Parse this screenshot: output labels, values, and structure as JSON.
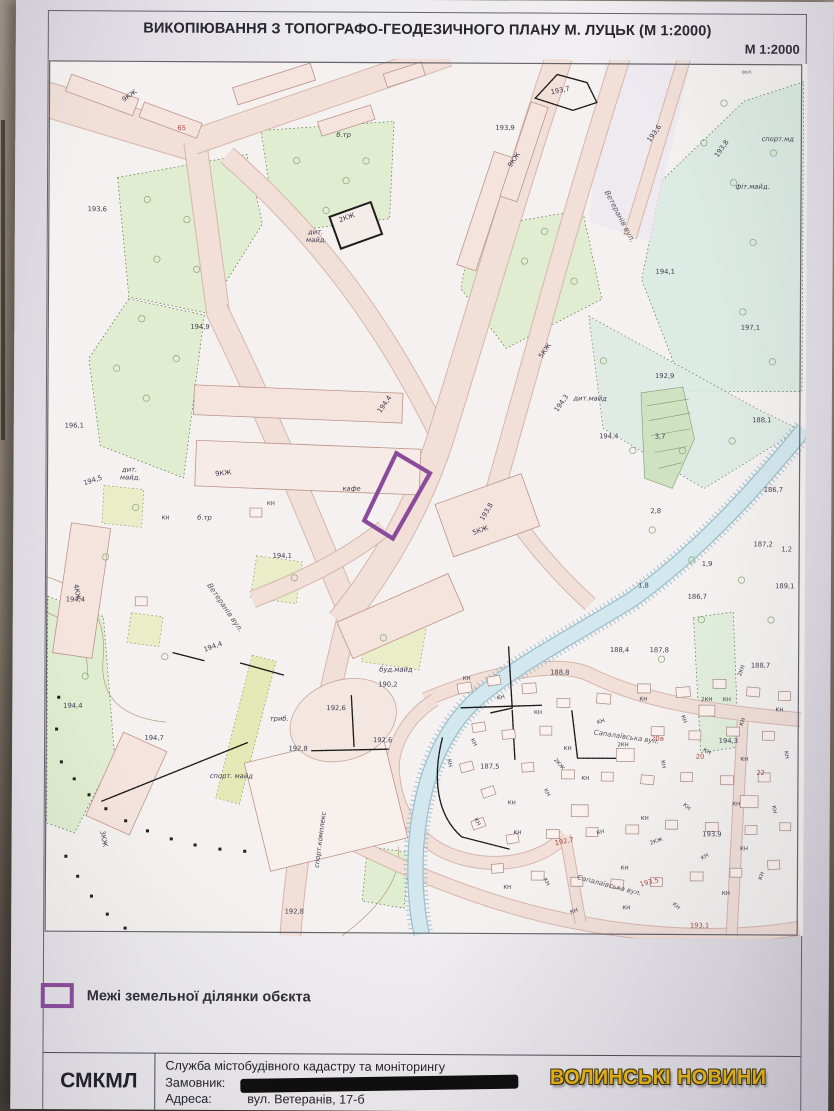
{
  "photo": {
    "watermark": "ВОЛИНСЬКІ НОВИНИ",
    "watermark_color": "#eab511"
  },
  "sheet": {
    "title": "ВИКОПІЮВАННЯ З ТОПОГРАФО-ГЕОДЕЗИЧНОГО ПЛАНУ М. ЛУЦЬК (М 1:2000)",
    "scale_label": "М 1:2000",
    "legend": {
      "swatch_color": "#8b4b9b",
      "label": "Межі земельної ділянки обєкта"
    },
    "footer": {
      "org_abbr": "СМКМЛ",
      "org_name": "Служба містобудівного кадастру та моніторингу",
      "customer_label": "Замовник:",
      "customer_value_redacted": true,
      "address_label": "Адреса:",
      "address_value": "вул. Ветеранів, 17-б"
    }
  },
  "map": {
    "parcel_color": "#8b4b9b",
    "label_colors": {
      "d": "#3c3c4e",
      "r": "#a8473d",
      "g": "#5b5762",
      "b": "#8a6f4e"
    },
    "labels": [
      {
        "t": "вол.",
        "x": 698,
        "y": 10,
        "s": 5,
        "c": "g"
      },
      {
        "t": "193,6",
        "x": 40,
        "y": 152
      },
      {
        "t": "194,9",
        "x": 144,
        "y": 270
      },
      {
        "t": "196,1",
        "x": 18,
        "y": 370
      },
      {
        "t": "194,5",
        "x": 38,
        "y": 428,
        "r": -18
      },
      {
        "t": "194,4",
        "x": 20,
        "y": 545
      },
      {
        "t": "194,1",
        "x": 228,
        "y": 500
      },
      {
        "t": "194,7",
        "x": 100,
        "y": 684
      },
      {
        "t": "194,4",
        "x": 18,
        "y": 652
      },
      {
        "t": "190,2",
        "x": 335,
        "y": 629
      },
      {
        "t": "192,8",
        "x": 245,
        "y": 694
      },
      {
        "t": "192,6",
        "x": 283,
        "y": 653
      },
      {
        "t": "192,6",
        "x": 330,
        "y": 685
      },
      {
        "t": "192,8",
        "x": 242,
        "y": 858
      },
      {
        "t": "194,4",
        "x": 160,
        "y": 595,
        "r": -20
      },
      {
        "t": "193,9",
        "x": 450,
        "y": 68
      },
      {
        "t": "193,7",
        "x": 506,
        "y": 32,
        "r": -12
      },
      {
        "t": "193,6",
        "x": 606,
        "y": 80,
        "r": -55
      },
      {
        "t": "193,8",
        "x": 674,
        "y": 95,
        "r": -55
      },
      {
        "t": "193,8",
        "x": 440,
        "y": 462,
        "r": -60
      },
      {
        "t": "194,1",
        "x": 612,
        "y": 212
      },
      {
        "t": "197,1",
        "x": 698,
        "y": 268
      },
      {
        "t": "192,9",
        "x": 612,
        "y": 317
      },
      {
        "t": "194,4",
        "x": 556,
        "y": 378
      },
      {
        "t": "3,7",
        "x": 612,
        "y": 378
      },
      {
        "t": "188,1",
        "x": 710,
        "y": 361
      },
      {
        "t": "186,7",
        "x": 722,
        "y": 431
      },
      {
        "t": "2,8",
        "x": 608,
        "y": 453
      },
      {
        "t": "187,2",
        "x": 712,
        "y": 486
      },
      {
        "t": "1,2",
        "x": 740,
        "y": 491
      },
      {
        "t": "189,1",
        "x": 734,
        "y": 528
      },
      {
        "t": "1,9",
        "x": 660,
        "y": 506
      },
      {
        "t": "1,8",
        "x": 596,
        "y": 528
      },
      {
        "t": "186,7",
        "x": 646,
        "y": 539
      },
      {
        "t": "188,4",
        "x": 568,
        "y": 593
      },
      {
        "t": "187,8",
        "x": 608,
        "y": 593
      },
      {
        "t": "188,8",
        "x": 508,
        "y": 616
      },
      {
        "t": "188,7",
        "x": 710,
        "y": 608
      },
      {
        "t": "194,3",
        "x": 678,
        "y": 684
      },
      {
        "t": "187,5",
        "x": 438,
        "y": 711
      },
      {
        "t": "193,9",
        "x": 662,
        "y": 778
      },
      {
        "t": "194,3",
        "x": 514,
        "y": 352,
        "r": -55
      },
      {
        "t": "194,4",
        "x": 336,
        "y": 354,
        "r": -55
      },
      {
        "t": "65",
        "x": 130,
        "y": 70,
        "c": "r"
      },
      {
        "t": "192,7",
        "x": 514,
        "y": 788,
        "c": "r",
        "r": -12
      },
      {
        "t": "193,5",
        "x": 600,
        "y": 829,
        "c": "r",
        "r": -14
      },
      {
        "t": "193,1",
        "x": 650,
        "y": 870,
        "c": "r"
      },
      {
        "t": "20а",
        "x": 610,
        "y": 682,
        "c": "r"
      },
      {
        "t": "20",
        "x": 655,
        "y": 700,
        "c": "r"
      },
      {
        "t": "22",
        "x": 716,
        "y": 716,
        "c": "r"
      },
      {
        "t": "дит.",
        "x": 262,
        "y": 174,
        "i": 1
      },
      {
        "t": "майд.",
        "x": 260,
        "y": 182,
        "i": 1
      },
      {
        "t": "дит.",
        "x": 76,
        "y": 414,
        "i": 1
      },
      {
        "t": "майд.",
        "x": 74,
        "y": 422,
        "i": 1
      },
      {
        "t": "дит.майд",
        "x": 530,
        "y": 340,
        "i": 1
      },
      {
        "t": "б.тр",
        "x": 290,
        "y": 76,
        "i": 1
      },
      {
        "t": "б.тр",
        "x": 152,
        "y": 462,
        "i": 1
      },
      {
        "t": "спорт.мд",
        "x": 718,
        "y": 78,
        "i": 1
      },
      {
        "t": "фіт.майд.",
        "x": 692,
        "y": 126,
        "i": 1
      },
      {
        "t": "триб.",
        "x": 226,
        "y": 664,
        "i": 1
      },
      {
        "t": "буд.майд",
        "x": 336,
        "y": 614,
        "i": 1
      },
      {
        "t": "спорт. майд",
        "x": 166,
        "y": 722,
        "i": 1
      },
      {
        "t": "спорт.комплекс",
        "x": 276,
        "y": 812,
        "i": 1,
        "r": -83
      },
      {
        "t": "кафе",
        "x": 298,
        "y": 432,
        "i": 1
      },
      {
        "t": "9КЖ",
        "x": 76,
        "y": 42,
        "r": -35
      },
      {
        "t": "9КЖ",
        "x": 170,
        "y": 418,
        "r": -6
      },
      {
        "t": "9КЖ",
        "x": 466,
        "y": 106,
        "r": -55
      },
      {
        "t": "5КЖ",
        "x": 498,
        "y": 298,
        "r": -55
      },
      {
        "t": "5КЖ",
        "x": 430,
        "y": 476,
        "r": -20
      },
      {
        "t": "4КЖ",
        "x": 28,
        "y": 528,
        "r": 80
      },
      {
        "t": "3КЖ",
        "x": 56,
        "y": 776,
        "r": 80
      },
      {
        "t": "2КЖ",
        "x": 294,
        "y": 162,
        "r": -20
      },
      {
        "t": "КН",
        "x": 222,
        "y": 447,
        "s": 5.5
      },
      {
        "t": "КН",
        "x": 116,
        "y": 462,
        "s": 5.5
      },
      {
        "t": "Ветеранів вул.",
        "x": 560,
        "y": 130,
        "r": 62,
        "c": "g",
        "s": 7.5,
        "i": 1
      },
      {
        "t": "Ветеранів вул.",
        "x": 162,
        "y": 528,
        "r": 55,
        "c": "g",
        "s": 7.5,
        "i": 1
      },
      {
        "t": "Сапалаївська вул.",
        "x": 552,
        "y": 676,
        "r": 8,
        "c": "g",
        "s": 7,
        "i": 1
      },
      {
        "t": "Сапалаївська вул.",
        "x": 536,
        "y": 822,
        "r": 14,
        "c": "g",
        "s": 7,
        "i": 1
      },
      {
        "t": "КН",
        "x": 455,
        "y": 642,
        "s": 5.5,
        "r": -15
      },
      {
        "t": "КН",
        "x": 492,
        "y": 656,
        "s": 5.5
      },
      {
        "t": "КН",
        "x": 428,
        "y": 682,
        "s": 5.5,
        "r": 60
      },
      {
        "t": "КН",
        "x": 522,
        "y": 692,
        "s": 5.5
      },
      {
        "t": "КН",
        "x": 556,
        "y": 666,
        "s": 5.5,
        "r": -20
      },
      {
        "t": "КН",
        "x": 598,
        "y": 642,
        "s": 5.5
      },
      {
        "t": "КН",
        "x": 640,
        "y": 657,
        "s": 5.5,
        "r": 70
      },
      {
        "t": "КН",
        "x": 682,
        "y": 642,
        "s": 5.5
      },
      {
        "t": "КН",
        "x": 702,
        "y": 667,
        "s": 5.5,
        "r": -70
      },
      {
        "t": "КН",
        "x": 735,
        "y": 652,
        "s": 5.5
      },
      {
        "t": "КН",
        "x": 744,
        "y": 692,
        "s": 5.5,
        "r": 80
      },
      {
        "t": "КН",
        "x": 700,
        "y": 702,
        "s": 5.5
      },
      {
        "t": "КН",
        "x": 662,
        "y": 692,
        "s": 5.5,
        "r": 30
      },
      {
        "t": "КН",
        "x": 620,
        "y": 702,
        "s": 5.5,
        "r": 80
      },
      {
        "t": "КН",
        "x": 540,
        "y": 722,
        "s": 5.5
      },
      {
        "t": "КН",
        "x": 502,
        "y": 732,
        "s": 5.5,
        "r": 60
      },
      {
        "t": "КН",
        "x": 466,
        "y": 747,
        "s": 5.5
      },
      {
        "t": "КН",
        "x": 432,
        "y": 762,
        "s": 5.5,
        "r": 60
      },
      {
        "t": "КН",
        "x": 472,
        "y": 777,
        "s": 5.5
      },
      {
        "t": "КН",
        "x": 556,
        "y": 777,
        "s": 5.5,
        "r": -15
      },
      {
        "t": "КН",
        "x": 600,
        "y": 762,
        "s": 5.5
      },
      {
        "t": "КН",
        "x": 642,
        "y": 747,
        "s": 5.5,
        "r": 40
      },
      {
        "t": "КН",
        "x": 692,
        "y": 747,
        "s": 5.5
      },
      {
        "t": "КН",
        "x": 732,
        "y": 747,
        "s": 5.5,
        "r": 80
      },
      {
        "t": "КН",
        "x": 700,
        "y": 792,
        "s": 5.5
      },
      {
        "t": "КН",
        "x": 662,
        "y": 802,
        "s": 5.5,
        "r": -30
      },
      {
        "t": "КН",
        "x": 580,
        "y": 812,
        "s": 5.5
      },
      {
        "t": "КН",
        "x": 502,
        "y": 822,
        "s": 5.5,
        "r": 60
      },
      {
        "t": "КН",
        "x": 462,
        "y": 832,
        "s": 5.5
      },
      {
        "t": "КН",
        "x": 530,
        "y": 857,
        "s": 5.5,
        "r": -20
      },
      {
        "t": "КН",
        "x": 582,
        "y": 852,
        "s": 5.5
      },
      {
        "t": "КН",
        "x": 632,
        "y": 847,
        "s": 5.5,
        "r": 40
      },
      {
        "t": "КН",
        "x": 682,
        "y": 837,
        "s": 5.5
      },
      {
        "t": "КН",
        "x": 722,
        "y": 822,
        "s": 5.5,
        "r": -70
      },
      {
        "t": "КН",
        "x": 420,
        "y": 622,
        "s": 5.5
      },
      {
        "t": "КН",
        "x": 405,
        "y": 702,
        "s": 5.5,
        "r": 80
      },
      {
        "t": "2КН",
        "x": 576,
        "y": 688,
        "s": 5.5
      },
      {
        "t": "2КН",
        "x": 700,
        "y": 617,
        "s": 5.5,
        "r": -70
      },
      {
        "t": "2КН",
        "x": 660,
        "y": 642,
        "s": 5.5
      },
      {
        "t": "2КЖ",
        "x": 512,
        "y": 702,
        "s": 5.5,
        "r": 50
      },
      {
        "t": "2КЖ",
        "x": 610,
        "y": 787,
        "s": 5.5,
        "r": -20
      }
    ],
    "houses": [
      [
        415,
        625,
        14,
        10,
        -10
      ],
      [
        445,
        618,
        13,
        9,
        -10
      ],
      [
        480,
        625,
        14,
        10,
        -5
      ],
      [
        515,
        640,
        13,
        9,
        0
      ],
      [
        555,
        635,
        14,
        10,
        5
      ],
      [
        596,
        625,
        13,
        9,
        0
      ],
      [
        635,
        628,
        14,
        10,
        -5
      ],
      [
        672,
        620,
        13,
        9,
        0
      ],
      [
        706,
        628,
        13,
        9,
        5
      ],
      [
        738,
        632,
        12,
        9,
        0
      ],
      [
        430,
        665,
        13,
        9,
        -10
      ],
      [
        460,
        672,
        13,
        9,
        -5
      ],
      [
        498,
        668,
        12,
        9,
        0
      ],
      [
        610,
        668,
        13,
        9,
        0
      ],
      [
        648,
        672,
        12,
        9,
        0
      ],
      [
        686,
        668,
        13,
        9,
        0
      ],
      [
        722,
        672,
        12,
        9,
        0
      ],
      [
        418,
        705,
        13,
        9,
        -15
      ],
      [
        440,
        730,
        13,
        9,
        -20
      ],
      [
        480,
        705,
        12,
        9,
        -5
      ],
      [
        520,
        712,
        13,
        9,
        0
      ],
      [
        560,
        714,
        12,
        9,
        0
      ],
      [
        600,
        717,
        13,
        9,
        5
      ],
      [
        640,
        714,
        12,
        9,
        0
      ],
      [
        680,
        717,
        13,
        9,
        0
      ],
      [
        718,
        714,
        12,
        9,
        0
      ],
      [
        430,
        762,
        13,
        9,
        -20
      ],
      [
        465,
        777,
        12,
        9,
        -10
      ],
      [
        505,
        772,
        13,
        9,
        0
      ],
      [
        545,
        770,
        12,
        9,
        0
      ],
      [
        585,
        767,
        13,
        9,
        0
      ],
      [
        625,
        762,
        12,
        9,
        0
      ],
      [
        665,
        764,
        13,
        9,
        0
      ],
      [
        705,
        767,
        12,
        9,
        0
      ],
      [
        740,
        764,
        11,
        8,
        0
      ],
      [
        450,
        807,
        12,
        9,
        -5
      ],
      [
        490,
        814,
        13,
        9,
        0
      ],
      [
        530,
        820,
        12,
        9,
        0
      ],
      [
        570,
        822,
        13,
        9,
        5
      ],
      [
        610,
        820,
        12,
        9,
        0
      ],
      [
        650,
        814,
        13,
        9,
        0
      ],
      [
        690,
        810,
        12,
        9,
        0
      ],
      [
        728,
        802,
        12,
        9,
        -5
      ],
      [
        575,
        690,
        18,
        13,
        0
      ],
      [
        530,
        747,
        17,
        12,
        0
      ],
      [
        700,
        737,
        18,
        12,
        0
      ],
      [
        658,
        646,
        16,
        11,
        0
      ],
      [
        90,
        540,
        12,
        9,
        0
      ],
      [
        205,
        450,
        12,
        9,
        0
      ]
    ],
    "trees": [
      [
        100,
        140
      ],
      [
        140,
        160
      ],
      [
        110,
        200
      ],
      [
        150,
        210
      ],
      [
        95,
        260
      ],
      [
        130,
        300
      ],
      [
        100,
        340
      ],
      [
        70,
        310
      ],
      [
        250,
        100
      ],
      [
        300,
        120
      ],
      [
        280,
        150
      ],
      [
        320,
        100
      ],
      [
        480,
        200
      ],
      [
        500,
        170
      ],
      [
        530,
        220
      ],
      [
        660,
        80
      ],
      [
        690,
        120
      ],
      [
        710,
        180
      ],
      [
        700,
        250
      ],
      [
        730,
        300
      ],
      [
        690,
        380
      ],
      [
        640,
        390
      ],
      [
        610,
        470
      ],
      [
        650,
        500
      ],
      [
        700,
        520
      ],
      [
        730,
        560
      ],
      [
        660,
        560
      ],
      [
        620,
        600
      ],
      [
        90,
        450
      ],
      [
        60,
        500
      ],
      [
        250,
        520
      ],
      [
        340,
        580
      ],
      [
        120,
        600
      ],
      [
        40,
        620
      ],
      [
        680,
        40
      ],
      [
        730,
        90
      ],
      [
        560,
        300
      ],
      [
        590,
        390
      ]
    ],
    "shrubs": [
      [
        15,
        705
      ],
      [
        28,
        722
      ],
      [
        43,
        738
      ],
      [
        60,
        752
      ],
      [
        80,
        764
      ],
      [
        102,
        774
      ],
      [
        126,
        782
      ],
      [
        150,
        788
      ],
      [
        175,
        792
      ],
      [
        200,
        794
      ],
      [
        20,
        800
      ],
      [
        32,
        820
      ],
      [
        46,
        840
      ],
      [
        62,
        858
      ],
      [
        80,
        872
      ],
      [
        100,
        884
      ],
      [
        12,
        640
      ],
      [
        10,
        672
      ]
    ]
  }
}
